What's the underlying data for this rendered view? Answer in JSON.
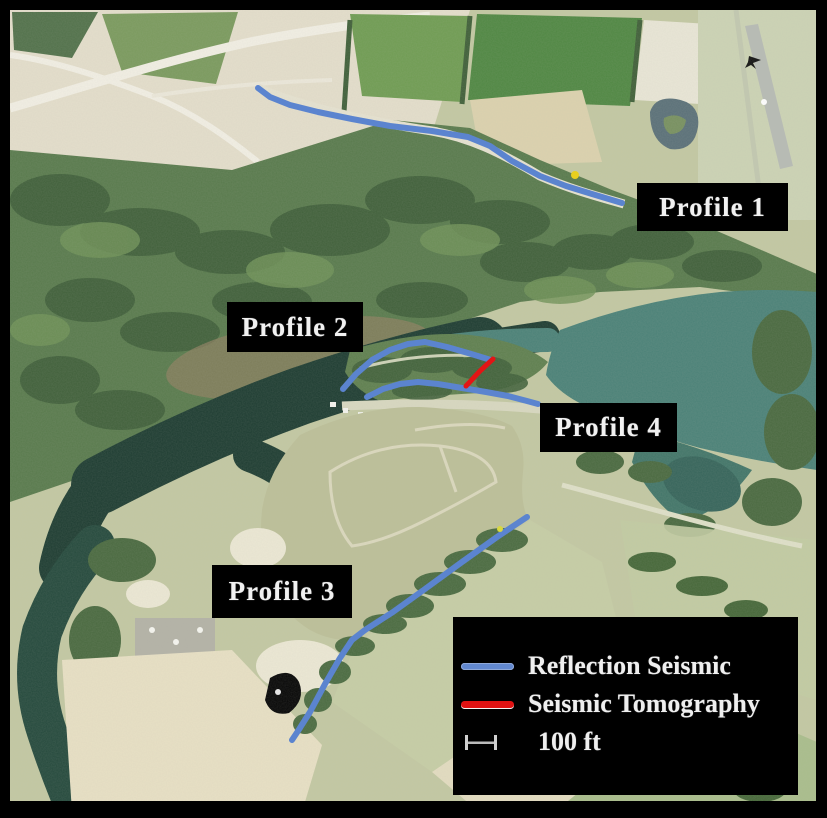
{
  "labels": {
    "profile1": "Profile 1",
    "profile2": "Profile 2",
    "profile3": "Profile 3",
    "profile4": "Profile 4"
  },
  "legend": {
    "items": [
      {
        "key": "reflection-seismic",
        "swatch_color": "#6288cf",
        "label": "Reflection Seismic"
      },
      {
        "key": "seismic-tomography",
        "swatch_color": "#e01212",
        "label": "Seismic Tomography"
      }
    ],
    "scale_bar": {
      "label": "100 ft"
    }
  },
  "annotations": {
    "profiles": [
      {
        "name": "profile-1-line",
        "type": "reflection-seismic",
        "color": "#5b84cf",
        "width": 6,
        "points": [
          [
            258,
            88
          ],
          [
            270,
            97
          ],
          [
            290,
            105
          ],
          [
            318,
            112
          ],
          [
            352,
            119
          ],
          [
            390,
            126
          ],
          [
            432,
            131
          ],
          [
            468,
            137
          ],
          [
            490,
            146
          ],
          [
            512,
            161
          ],
          [
            540,
            176
          ],
          [
            566,
            186
          ],
          [
            592,
            194
          ],
          [
            622,
            203
          ]
        ]
      },
      {
        "name": "profile-2-line",
        "type": "reflection-seismic",
        "color": "#5b84cf",
        "width": 6,
        "points": [
          [
            343,
            389
          ],
          [
            356,
            374
          ],
          [
            372,
            360
          ],
          [
            390,
            350
          ],
          [
            408,
            344
          ],
          [
            425,
            342
          ],
          [
            447,
            347
          ],
          [
            468,
            353
          ],
          [
            491,
            360
          ]
        ]
      },
      {
        "name": "profile-4-line",
        "type": "reflection-seismic",
        "color": "#5b84cf",
        "width": 6,
        "points": [
          [
            367,
            397
          ],
          [
            383,
            389
          ],
          [
            400,
            384
          ],
          [
            418,
            382
          ],
          [
            438,
            384
          ],
          [
            462,
            388
          ],
          [
            486,
            392
          ],
          [
            508,
            396
          ],
          [
            527,
            401
          ],
          [
            538,
            404
          ]
        ]
      },
      {
        "name": "profile-3-line",
        "type": "reflection-seismic",
        "color": "#5b84cf",
        "width": 6,
        "points": [
          [
            527,
            517
          ],
          [
            497,
            537
          ],
          [
            462,
            562
          ],
          [
            425,
            589
          ],
          [
            393,
            612
          ],
          [
            365,
            630
          ],
          [
            352,
            640
          ],
          [
            340,
            658
          ],
          [
            325,
            684
          ],
          [
            310,
            712
          ],
          [
            298,
            731
          ],
          [
            292,
            740
          ]
        ]
      },
      {
        "name": "tomography-line",
        "type": "seismic-tomography",
        "color": "#e31515",
        "width": 5,
        "points": [
          [
            493,
            359
          ],
          [
            480,
            371
          ],
          [
            466,
            386
          ]
        ]
      }
    ],
    "markers": [
      {
        "name": "yellow-dot-profile1",
        "color": "#e8cf1f",
        "x": 575,
        "y": 175,
        "r": 4
      },
      {
        "name": "yellow-dot-profile3",
        "color": "#d8d840",
        "x": 500,
        "y": 529,
        "r": 3
      }
    ]
  }
}
